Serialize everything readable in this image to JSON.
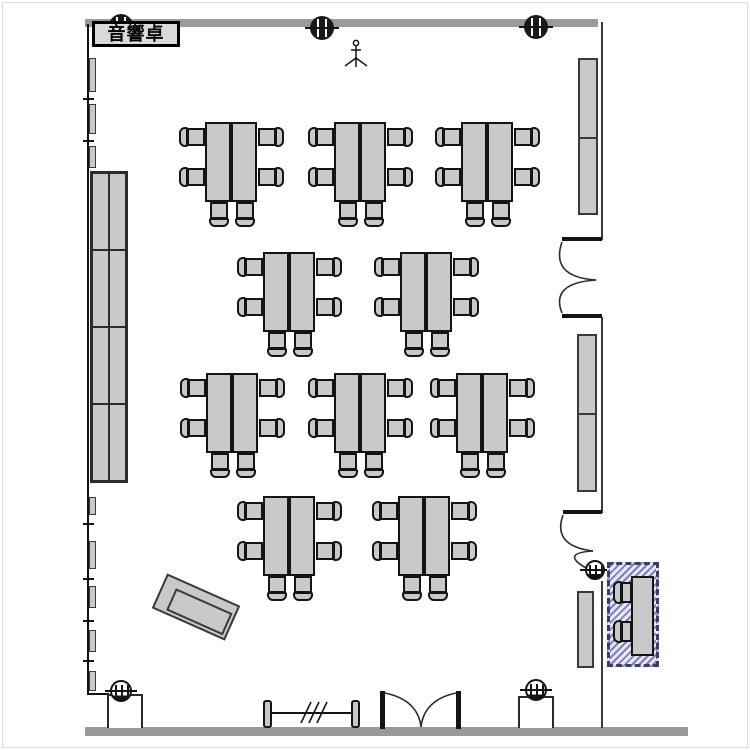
{
  "labels": {
    "audio_console": "音響卓"
  },
  "colors": {
    "furniture_fill": "#c9c9c9",
    "furniture_stroke": "#141414",
    "wall_gray": "#9a9a9a",
    "wall_dark": "#2b2b2b",
    "hatch_line": "#7d7dbd",
    "hatch_bg": "#e8e8f4",
    "hatch_border": "#3c3c6e"
  },
  "inventory": {
    "table_groups": {
      "count": 10,
      "tables_per_group": 2,
      "chairs_per_group": 6,
      "positions": [
        {
          "x": 179,
          "y": 122
        },
        {
          "x": 308,
          "y": 122
        },
        {
          "x": 435,
          "y": 122
        },
        {
          "x": 237,
          "y": 252
        },
        {
          "x": 374,
          "y": 252
        },
        {
          "x": 180,
          "y": 373
        },
        {
          "x": 308,
          "y": 373
        },
        {
          "x": 430,
          "y": 373
        },
        {
          "x": 237,
          "y": 496
        },
        {
          "x": 372,
          "y": 496
        }
      ]
    },
    "wall_cabinets": {
      "x": 90,
      "y": 171,
      "width": 38,
      "height": 312,
      "rows": 4,
      "cols": 2
    },
    "side_panels": [
      {
        "x": 578,
        "y": 58,
        "width": 20,
        "height": 157,
        "sections": 2
      },
      {
        "x": 577,
        "y": 334,
        "width": 20,
        "height": 158,
        "sections": 2
      },
      {
        "x": 577,
        "y": 591,
        "width": 17,
        "height": 77,
        "sections": 1
      }
    ],
    "hatched_station": {
      "x": 607,
      "y": 562,
      "width": 52,
      "height": 105,
      "chairs": 2
    },
    "podium": {
      "x": 156,
      "y": 588,
      "width": 80,
      "height": 38,
      "angle_deg": 24
    },
    "columns_dark": [
      {
        "cx": 121,
        "cy": 26
      },
      {
        "cx": 322,
        "cy": 28
      },
      {
        "cx": 536,
        "cy": 27
      }
    ],
    "columns_light": [
      {
        "cx": 121,
        "cy": 691
      },
      {
        "cx": 536,
        "cy": 690
      },
      {
        "cx": 595,
        "cy": 570
      }
    ],
    "doors": [
      "double-door-right-upper",
      "door-right-lower",
      "double-door-bottom"
    ],
    "mic_stand": {
      "x": 356,
      "y": 54
    }
  }
}
